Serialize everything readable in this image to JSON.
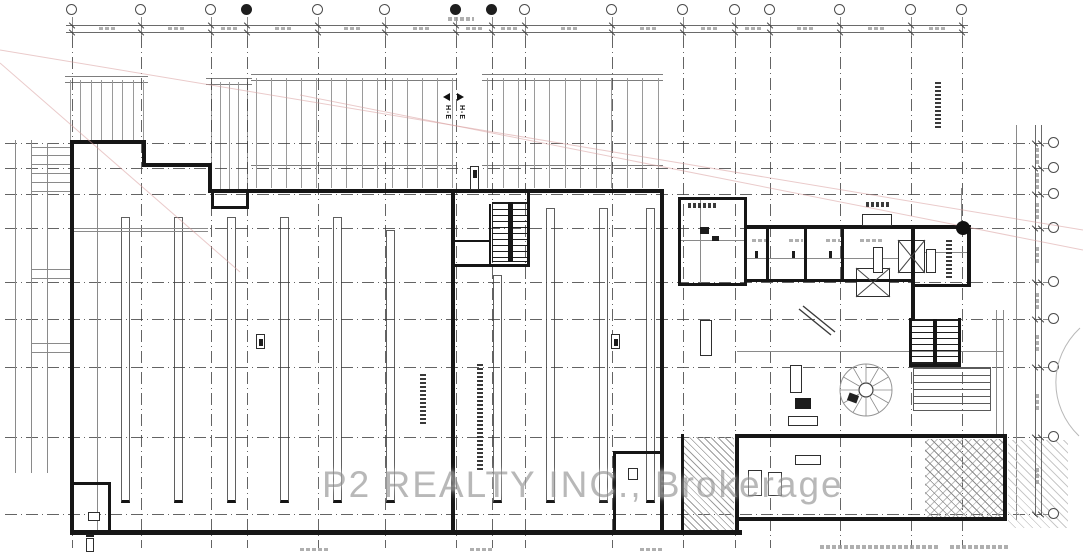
{
  "watermark": {
    "text": "P2 REALTY INC., Brokerage",
    "x": 322,
    "y": 464
  },
  "section_markers": {
    "left": {
      "x": 443,
      "y": 93,
      "label": "H-E"
    },
    "right": {
      "x": 457,
      "y": 93,
      "label": "H-E"
    }
  },
  "colors": {
    "wall": "#161616",
    "grid": "#3d3d3d",
    "red_line": "#d9a0a0",
    "watermark": "#9e9e9e"
  },
  "grid": {
    "vertical_x": [
      72,
      141,
      211,
      247,
      318,
      385,
      456,
      492,
      525,
      612,
      683,
      735,
      770,
      840,
      911,
      962
    ],
    "filled_bubbles": [
      3,
      6,
      7
    ],
    "horizontal_y": [
      143,
      168,
      194,
      228,
      282,
      319,
      367,
      437,
      514
    ],
    "bubble_y": 10,
    "right_bubble_x": 1054
  },
  "dimensions": {
    "top": {
      "y1": 25,
      "y2": 32,
      "x_start": 66,
      "x_end": 968
    },
    "right": {
      "x1": 1035,
      "x2": 1041,
      "y_start": 125,
      "y_end": 516
    }
  },
  "walls": [
    [
      70,
      140,
      76,
      4
    ],
    [
      142,
      140,
      4,
      27
    ],
    [
      142,
      163,
      70,
      4
    ],
    [
      208,
      163,
      4,
      30
    ],
    [
      208,
      189,
      456,
      4
    ],
    [
      70,
      140,
      4,
      395
    ],
    [
      70,
      530,
      672,
      5
    ],
    [
      660,
      189,
      4,
      345
    ],
    [
      451,
      189,
      4,
      345
    ],
    [
      527,
      189,
      3,
      78
    ],
    [
      451,
      264,
      79,
      3
    ],
    [
      489,
      204,
      2,
      60
    ],
    [
      455,
      240,
      34,
      2
    ],
    [
      211,
      191,
      3,
      18
    ],
    [
      246,
      191,
      3,
      18
    ],
    [
      211,
      206,
      38,
      3
    ],
    [
      678,
      197,
      69,
      3
    ],
    [
      678,
      197,
      3,
      89
    ],
    [
      744,
      197,
      3,
      89
    ],
    [
      678,
      283,
      69,
      3
    ],
    [
      747,
      225,
      224,
      4
    ],
    [
      967,
      225,
      4,
      62
    ],
    [
      911,
      284,
      60,
      3
    ],
    [
      911,
      225,
      4,
      96
    ],
    [
      747,
      279,
      166,
      3
    ],
    [
      766,
      228,
      3,
      53
    ],
    [
      804,
      228,
      3,
      53
    ],
    [
      841,
      228,
      3,
      53
    ],
    [
      909,
      318,
      3,
      49
    ],
    [
      958,
      318,
      3,
      49
    ],
    [
      909,
      364,
      52,
      3
    ],
    [
      735,
      434,
      272,
      4
    ],
    [
      1003,
      434,
      4,
      87
    ],
    [
      735,
      517,
      270,
      4
    ],
    [
      735,
      434,
      4,
      99
    ],
    [
      681,
      434,
      3,
      99
    ],
    [
      108,
      482,
      3,
      51
    ],
    [
      70,
      482,
      41,
      3
    ],
    [
      613,
      451,
      3,
      81
    ],
    [
      613,
      451,
      48,
      3
    ],
    [
      508,
      202,
      5,
      60
    ],
    [
      933,
      319,
      4,
      45
    ]
  ],
  "gray_lines": [
    [
      74,
      228,
      134,
      1
    ],
    [
      74,
      231,
      134,
      1
    ],
    [
      97,
      143,
      1,
      388
    ],
    [
      961,
      188,
      1,
      38
    ],
    [
      737,
      351,
      266,
      1
    ],
    [
      996,
      310,
      1,
      124
    ],
    [
      1003,
      310,
      1,
      124
    ],
    [
      1016,
      125,
      1,
      395
    ],
    [
      681,
      240,
      64,
      1
    ],
    [
      700,
      200,
      1,
      83
    ],
    [
      31,
      147,
      39,
      1
    ],
    [
      31,
      155,
      39,
      1
    ],
    [
      31,
      164,
      39,
      1
    ],
    [
      31,
      173,
      39,
      1
    ],
    [
      31,
      182,
      39,
      1
    ],
    [
      31,
      191,
      39,
      1
    ],
    [
      31,
      269,
      39,
      1
    ],
    [
      31,
      278,
      39,
      1
    ],
    [
      31,
      343,
      39,
      1
    ],
    [
      31,
      352,
      39,
      1
    ],
    [
      15,
      140,
      1,
      333
    ],
    [
      31,
      140,
      1,
      333
    ],
    [
      47,
      143,
      1,
      330
    ],
    [
      913,
      252,
      54,
      1
    ],
    [
      747,
      258,
      164,
      1
    ]
  ],
  "docks": [
    {
      "x1": 70,
      "x2": 143,
      "y1": 80,
      "y2": 140,
      "n": 8,
      "rails": [
        76,
        82
      ]
    },
    {
      "x1": 211,
      "x2": 247,
      "y1": 82,
      "y2": 191,
      "n": 5,
      "rails": [
        78,
        84
      ]
    },
    {
      "x1": 256,
      "x2": 452,
      "y1": 78,
      "y2": 188,
      "n": 14,
      "rails": [
        74,
        80,
        165
      ]
    },
    {
      "x1": 487,
      "x2": 658,
      "y1": 78,
      "y2": 188,
      "n": 12,
      "rails": [
        74,
        80,
        165
      ]
    }
  ],
  "racks": [
    {
      "x": 121,
      "y1": 217,
      "y2": 503
    },
    {
      "x": 174,
      "y1": 217,
      "y2": 503
    },
    {
      "x": 227,
      "y1": 217,
      "y2": 503
    },
    {
      "x": 280,
      "y1": 217,
      "y2": 503
    },
    {
      "x": 333,
      "y1": 217,
      "y2": 503
    },
    {
      "x": 386,
      "y1": 230,
      "y2": 503
    },
    {
      "x": 493,
      "y1": 275,
      "y2": 503
    },
    {
      "x": 546,
      "y1": 208,
      "y2": 503
    },
    {
      "x": 599,
      "y1": 208,
      "y2": 503
    },
    {
      "x": 646,
      "y1": 208,
      "y2": 503
    }
  ],
  "treads": [
    {
      "x": 492,
      "y": 202,
      "w": 38,
      "h": 60,
      "pitch": 6,
      "light": false
    },
    {
      "x": 911,
      "y": 319,
      "w": 50,
      "h": 45,
      "pitch": 6,
      "light": false
    },
    {
      "x": 913,
      "y": 367,
      "w": 78,
      "h": 44,
      "pitch": 7,
      "light": true
    }
  ],
  "hatches": [
    {
      "x": 925,
      "y": 439,
      "w": 78,
      "h": 78,
      "kind": "cross"
    },
    {
      "x": 684,
      "y": 437,
      "w": 50,
      "h": 93,
      "kind": "left"
    },
    {
      "x": 1008,
      "y": 440,
      "w": 60,
      "h": 88,
      "kind": "light"
    }
  ],
  "xboxes": [
    [
      898,
      240,
      27,
      33
    ],
    [
      856,
      268,
      34,
      29
    ]
  ],
  "fixtures": [
    [
      862,
      214,
      30,
      12
    ],
    [
      873,
      247,
      10,
      26
    ],
    [
      926,
      249,
      10,
      24
    ],
    [
      748,
      470,
      14,
      26
    ],
    [
      768,
      472,
      14,
      24
    ],
    [
      795,
      455,
      26,
      10
    ],
    [
      700,
      320,
      12,
      36
    ],
    [
      790,
      365,
      12,
      28
    ],
    [
      788,
      416,
      30,
      10
    ],
    [
      256,
      334,
      9,
      15
    ],
    [
      611,
      334,
      9,
      15
    ],
    [
      86,
      538,
      8,
      14
    ],
    [
      88,
      512,
      12,
      9
    ],
    [
      628,
      468,
      10,
      12
    ],
    [
      470,
      166,
      9,
      24
    ]
  ],
  "darkmarks": [
    [
      755,
      251,
      3,
      7
    ],
    [
      792,
      251,
      3,
      7
    ],
    [
      829,
      251,
      3,
      7
    ],
    [
      700,
      227,
      9,
      7
    ],
    [
      712,
      236,
      7,
      5
    ],
    [
      795,
      398,
      16,
      11
    ],
    [
      86,
      534,
      8,
      3
    ],
    [
      259,
      339,
      4,
      7
    ],
    [
      614,
      339,
      4,
      7
    ],
    [
      473,
      170,
      4,
      8
    ]
  ],
  "annotations_v": [
    [
      420,
      374,
      6,
      50
    ],
    [
      477,
      364,
      6,
      106
    ],
    [
      935,
      82,
      6,
      48
    ],
    [
      946,
      240,
      6,
      40
    ]
  ],
  "annotations_h": [
    [
      866,
      202,
      24,
      5
    ],
    [
      688,
      203,
      28,
      5
    ]
  ],
  "gray_smudges": [
    [
      752,
      239,
      14,
      3
    ],
    [
      789,
      239,
      14,
      3
    ],
    [
      826,
      239,
      14,
      3
    ],
    [
      860,
      239,
      22,
      3
    ],
    [
      300,
      548,
      28,
      3
    ],
    [
      470,
      548,
      24,
      3
    ],
    [
      640,
      548,
      24,
      3
    ],
    [
      820,
      545,
      120,
      4
    ],
    [
      950,
      545,
      60,
      4
    ],
    [
      448,
      17,
      26,
      4
    ]
  ],
  "red_lines": [
    [
      0,
      50,
      1083,
      230
    ],
    [
      0,
      63,
      240,
      272
    ],
    [
      300,
      95,
      1083,
      250
    ]
  ],
  "diag_object": [
    [
      799,
      309,
      831,
      335
    ],
    [
      803,
      306,
      835,
      332
    ]
  ],
  "spiral": {
    "cx": 866,
    "cy": 390,
    "r": 26,
    "ri": 7,
    "spokes": 12
  },
  "arc_path": "M1080,328 C1048,358 1048,406 1079,436,",
  "column_dot": {
    "x": 963,
    "y": 228,
    "r": 7
  }
}
